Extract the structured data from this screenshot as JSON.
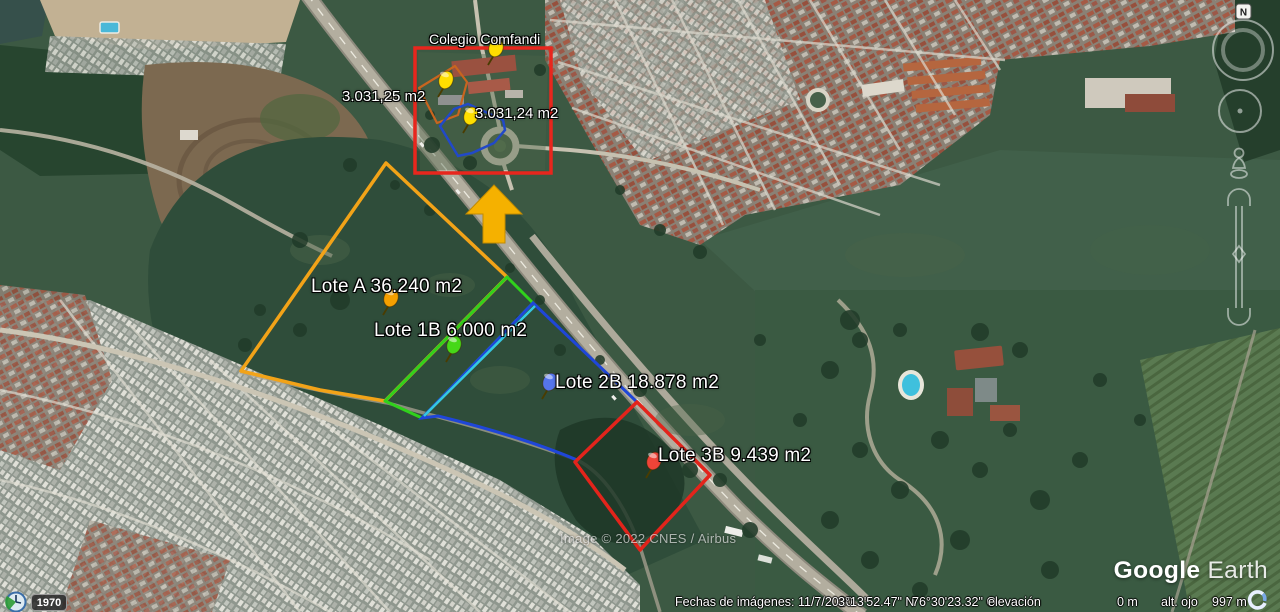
{
  "app": {
    "logo_primary": "Google",
    "logo_secondary": "Earth"
  },
  "compass": {
    "north_label": "N"
  },
  "time_slider": {
    "year_label": "1970"
  },
  "map": {
    "site_label": "Colegio Comfandi",
    "highlight_box_color": "#e8261d",
    "arrow_color": "#f5b100",
    "divider_color": "#35c8e0",
    "pin_yellow": "#ffdf00",
    "sub_parcels": [
      {
        "label": "3.031,25 m2",
        "outline_color": "#c8651f"
      },
      {
        "label": "3.031,24 m2",
        "outline_color": "#2149c8"
      }
    ],
    "lots": [
      {
        "label": "Lote A 36.240 m2",
        "outline_color": "#f2a318",
        "pin_color": "#f5a000"
      },
      {
        "label": "Lote 1B 6.000 m2",
        "outline_color": "#30d11c",
        "pin_color": "#46d818"
      },
      {
        "label": "Lote 2B 18.878 m2",
        "outline_color": "#1f46d8",
        "pin_color": "#5575ec"
      },
      {
        "label": "Lote 3B 9.439 m2",
        "outline_color": "#e3241b",
        "pin_color": "#ef4438"
      }
    ]
  },
  "watermark": "Image © 2022 CNES / Airbus",
  "status_bar": {
    "imagery_date": "Fechas de imágenes: 11/7/2020",
    "latitude": "3°13'52.47\" N",
    "longitude": "76°30'23.32\" O",
    "elevation_label": "elevación",
    "elevation_value": "0 m",
    "eye_altitude_label": "alt. ojo",
    "eye_altitude_value": "997 m"
  }
}
